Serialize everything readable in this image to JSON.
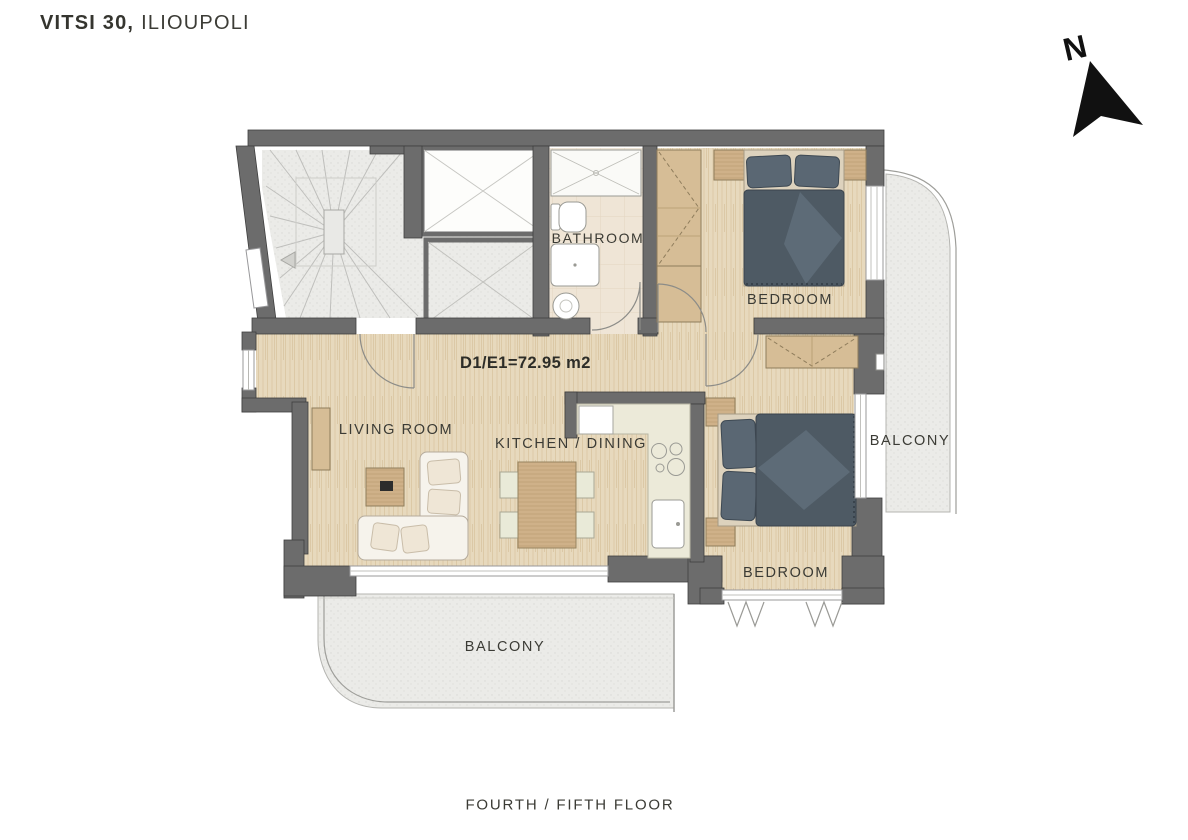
{
  "title": {
    "project": "VITSI 30,",
    "location": "ILIOUPOLI"
  },
  "compass": {
    "north_label": "N"
  },
  "unit": {
    "area_label": "D1/E1=72.95 m2",
    "floor_label": "FOURTH / FIFTH FLOOR"
  },
  "rooms": {
    "bathroom": {
      "label": "BATHROOM"
    },
    "bedroom_top": {
      "label": "BEDROOM"
    },
    "bedroom_bottom": {
      "label": "BEDROOM"
    },
    "living_room": {
      "label": "LIVING ROOM"
    },
    "kitchen_dining": {
      "label": "KITCHEN / DINING"
    },
    "balcony_right": {
      "label": "BALCONY"
    },
    "balcony_bottom": {
      "label": "BALCONY"
    }
  },
  "colors": {
    "wall": "#6c6c6c",
    "wood_floor": "#e6d8bc",
    "paved_area": "#ebebe8",
    "bathroom_tile": "#efe5d6",
    "bed_fabric": "#4e5a64",
    "kitchen_counter": "#ecead9",
    "furniture_wood": "#cfb189",
    "text": "#3b3b35"
  }
}
